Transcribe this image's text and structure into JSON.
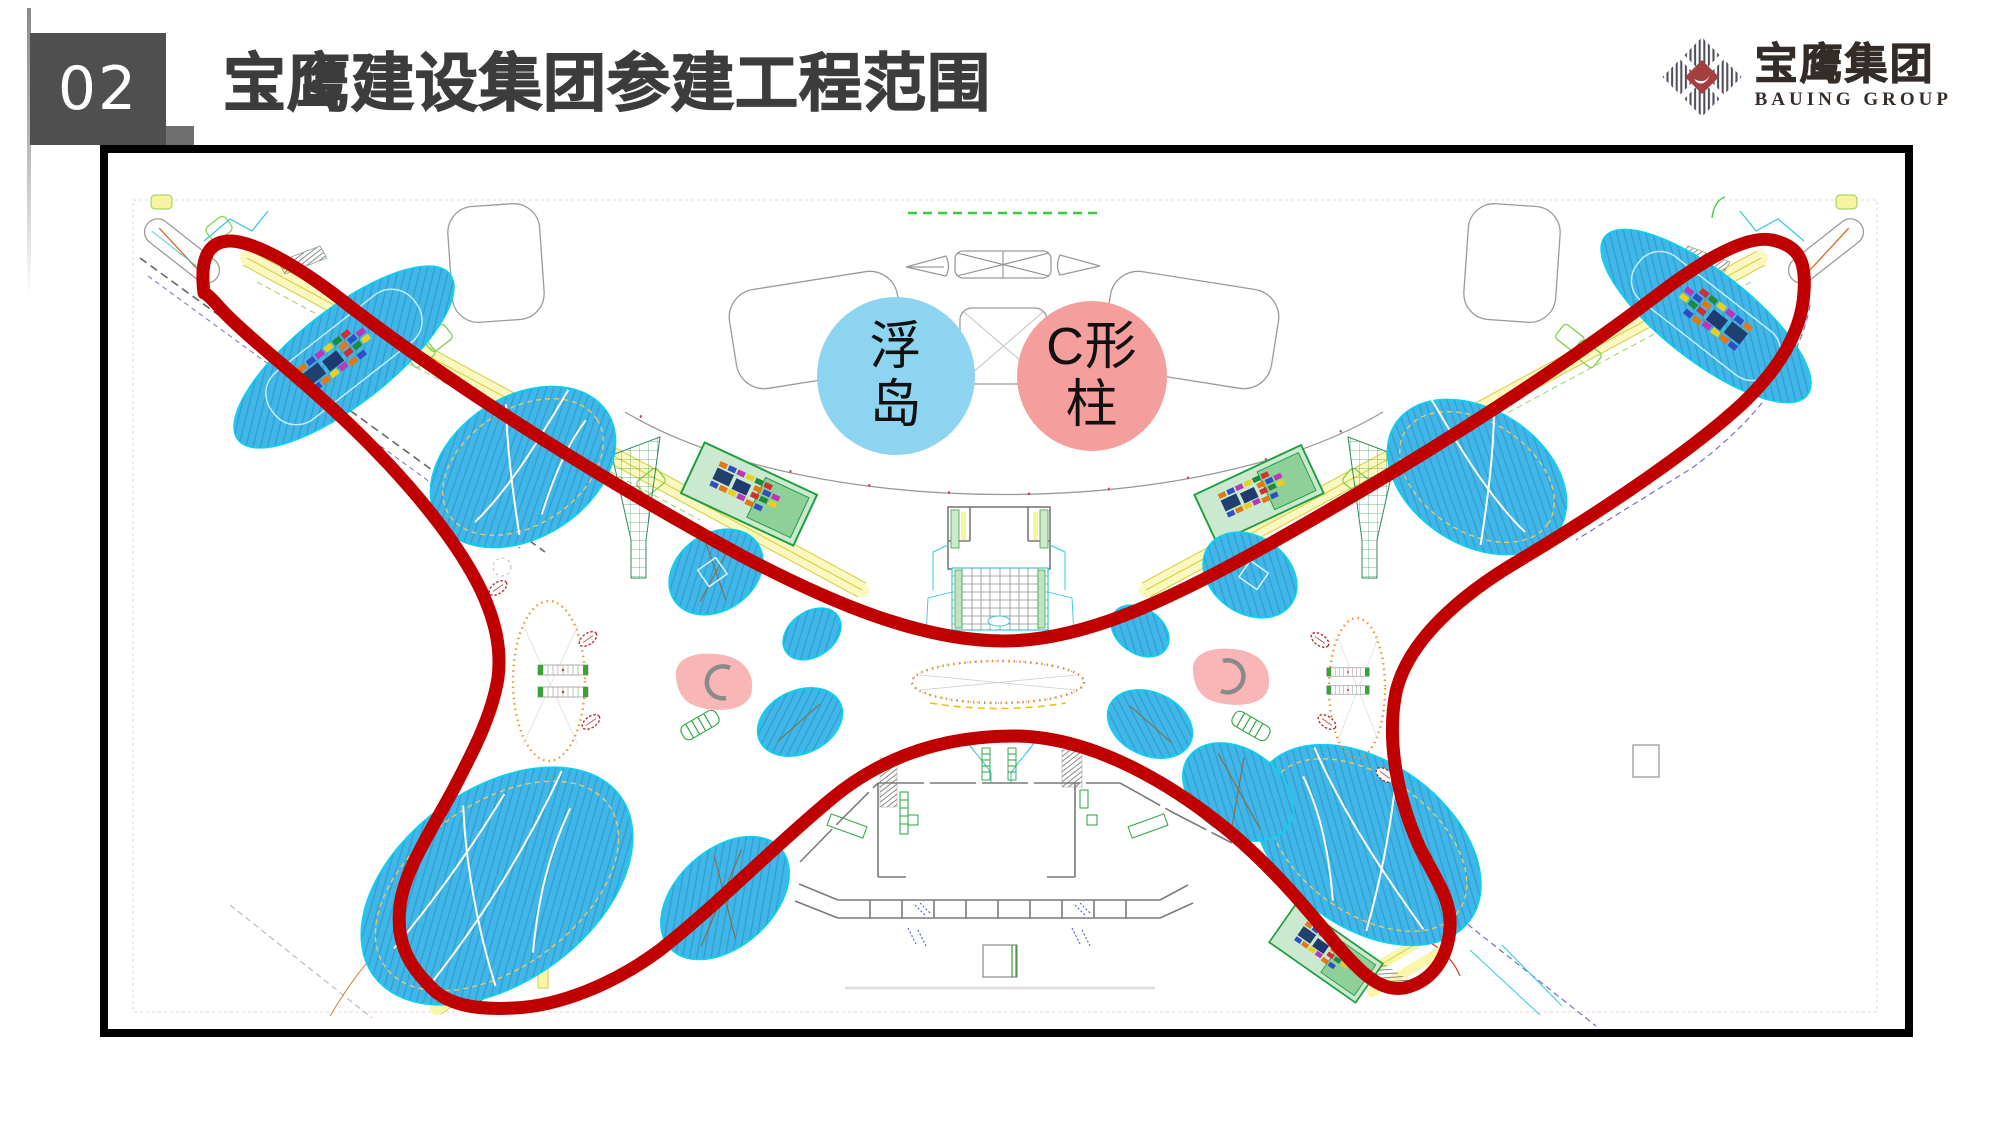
{
  "slide": {
    "number": "02",
    "title": "宝鹰建设集团参建工程范围"
  },
  "logo": {
    "name_cn": "宝鹰集团",
    "name_en": "BAUING GROUP"
  },
  "legend": {
    "floating_island": {
      "line1": "浮",
      "line2": "岛",
      "fill": "#8DD4F1"
    },
    "c_column": {
      "line1": "C形",
      "line2": "柱",
      "fill": "#F59E9E"
    }
  },
  "plan": {
    "type": "airport-terminal-floor-plan",
    "boundary_meaning": "参建工程范围 (scope of works outline)",
    "colors": {
      "boundary_red": "#C00000",
      "island_blue": "#41B6E8",
      "island_edge_cyan": "#18CBEF",
      "legend_island_blue": "#8DD4F1",
      "legend_column_pink": "#F59E9E",
      "column_marker_pink": "#F8B6B6",
      "band_yellow": "#FBF7A8",
      "zone_green": "#1F9E40",
      "slide_number_bg": "#4F4F4F",
      "title_gray": "#3C3C3C",
      "logo_red": "#A43F3F"
    }
  }
}
